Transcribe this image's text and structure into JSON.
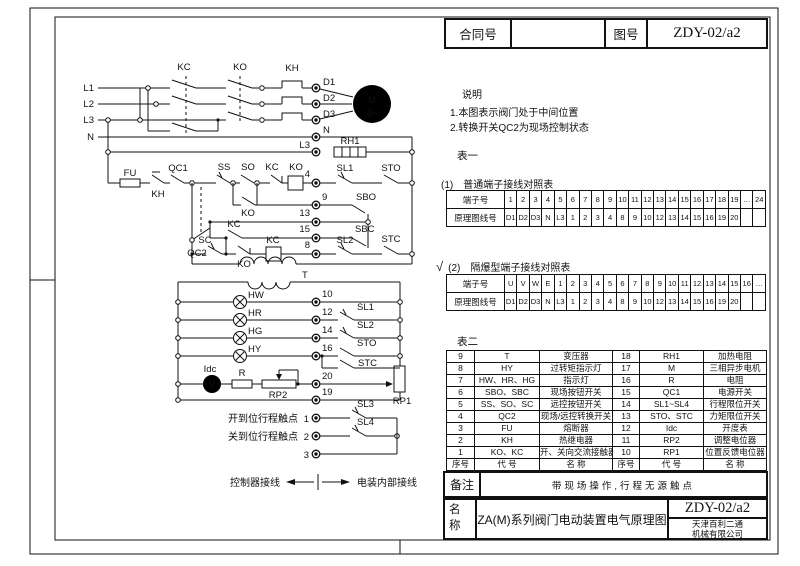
{
  "title_block_top": {
    "contract_label": "合同号",
    "contract_value": "",
    "drawing_no_label": "图号",
    "drawing_no_value": "ZDY-02/a2"
  },
  "notes": {
    "heading": "说明",
    "items": [
      "1.本图表示阀门处于中间位置",
      "2.转换开关QC2为现场控制状态"
    ]
  },
  "table1": {
    "heading": "表一",
    "sub1_num": "(1)",
    "sub1_title": "普通端子接线对照表",
    "checkmark": "√",
    "sub2_num": "(2)",
    "sub2_title": "隔爆型端子接线对照表",
    "normal_rows": [
      [
        "端子号",
        "1",
        "2",
        "3",
        "4",
        "5",
        "6",
        "7",
        "8",
        "9",
        "10",
        "11",
        "12",
        "13",
        "14",
        "15",
        "16",
        "17",
        "18",
        "19",
        "…",
        "24"
      ],
      [
        "原理图线号",
        "D1",
        "D2",
        "D3",
        "N",
        "L3",
        "1",
        "2",
        "3",
        "4",
        "8",
        "9",
        "10",
        "12",
        "13",
        "14",
        "15",
        "16",
        "19",
        "20",
        "",
        ""
      ]
    ],
    "flameproof_rows": [
      [
        "端子号",
        "U",
        "V",
        "W",
        "E",
        "1",
        "2",
        "3",
        "4",
        "5",
        "6",
        "7",
        "8",
        "9",
        "10",
        "11",
        "12",
        "13",
        "14",
        "15",
        "16",
        "…"
      ],
      [
        "原理图线号",
        "D1",
        "D2",
        "D3",
        "N",
        "L3",
        "1",
        "2",
        "3",
        "4",
        "8",
        "9",
        "10",
        "12",
        "13",
        "14",
        "15",
        "16",
        "19",
        "20",
        "",
        ""
      ]
    ]
  },
  "table2": {
    "heading": "表二",
    "rows": [
      [
        "9",
        "T",
        "变压器",
        "18",
        "RH1",
        "加热电阻"
      ],
      [
        "8",
        "HY",
        "过转矩指示灯",
        "17",
        "M",
        "三相异步电机"
      ],
      [
        "7",
        "HW、HR、HG",
        "指示灯",
        "16",
        "R",
        "电阻"
      ],
      [
        "6",
        "SBO、SBC",
        "现场按钮开关",
        "15",
        "QC1",
        "电源开关"
      ],
      [
        "5",
        "SS、SO、SC",
        "远控按钮开关",
        "14",
        "SL1~SL4",
        "行程限位开关"
      ],
      [
        "4",
        "QC2",
        "现场/远控转换开关",
        "13",
        "STO、STC",
        "力矩限位开关"
      ],
      [
        "3",
        "FU",
        "熔断器",
        "12",
        "Idc",
        "开度表"
      ],
      [
        "2",
        "KH",
        "热继电器",
        "11",
        "RP2",
        "调整电位器"
      ],
      [
        "1",
        "KO、KC",
        "开、关向交流接触器",
        "10",
        "RP1",
        "位置反馈电位器"
      ],
      [
        "序号",
        "代 号",
        "名 称",
        "序号",
        "代 号",
        "名 称"
      ]
    ]
  },
  "remark": {
    "label": "备注",
    "text": "带现场操作,行程无源触点"
  },
  "name_block": {
    "label": "名称",
    "title": "ZA(M)系列阀门电动装置电气原理图",
    "drawing_no": "ZDY-02/a2",
    "company_line1": "天津百利二通",
    "company_line2": "机械有限公司"
  },
  "schematic": {
    "l1": "L1",
    "l2": "L2",
    "l3": "L3",
    "n": "N",
    "kc_top": "KC",
    "ko_top": "KO",
    "kh_top": "KH",
    "d1": "D1",
    "d2": "D2",
    "d3": "D3",
    "term_n": "N",
    "term_l3": "L3",
    "rh1": "RH1",
    "motor_m": "M",
    "motor_ph": "3~",
    "fu": "FU",
    "kh2": "KH",
    "qc1": "QC1",
    "qc2": "QC2",
    "ss": "SS",
    "so": "SO",
    "kc_nc": "KC",
    "ko_coil": "KO",
    "t4": "4",
    "sl1": "SL1",
    "sto": "STO",
    "ko_par": "KO",
    "t9": "9",
    "sbo": "SBO",
    "t13": "13",
    "kc_par": "KC",
    "t15": "15",
    "sbc": "SBC",
    "sc": "SC",
    "ko_nc": "KO",
    "kc_coil": "KC",
    "t8": "8",
    "sl2": "SL2",
    "stc": "STC",
    "t_label": "T",
    "hw": "HW",
    "hr": "HR",
    "hg": "HG",
    "hy": "HY",
    "t10": "10",
    "t12": "12",
    "t14": "14",
    "t16": "16",
    "sl1b": "SL1",
    "sl2b": "SL2",
    "stob": "STO",
    "stcb": "STC",
    "idc": "Idc",
    "meter_glyph": "V",
    "r_label": "R",
    "rp2": "RP2",
    "t20": "20",
    "t19": "19",
    "rp1": "RP1",
    "open_label": "开到位行程触点",
    "t1": "1",
    "sl3": "SL3",
    "close_label": "关到位行程触点",
    "t2": "2",
    "sl4": "SL4",
    "t3": "3",
    "legend_left": "控制器接线",
    "legend_right": "电装内部接线"
  }
}
